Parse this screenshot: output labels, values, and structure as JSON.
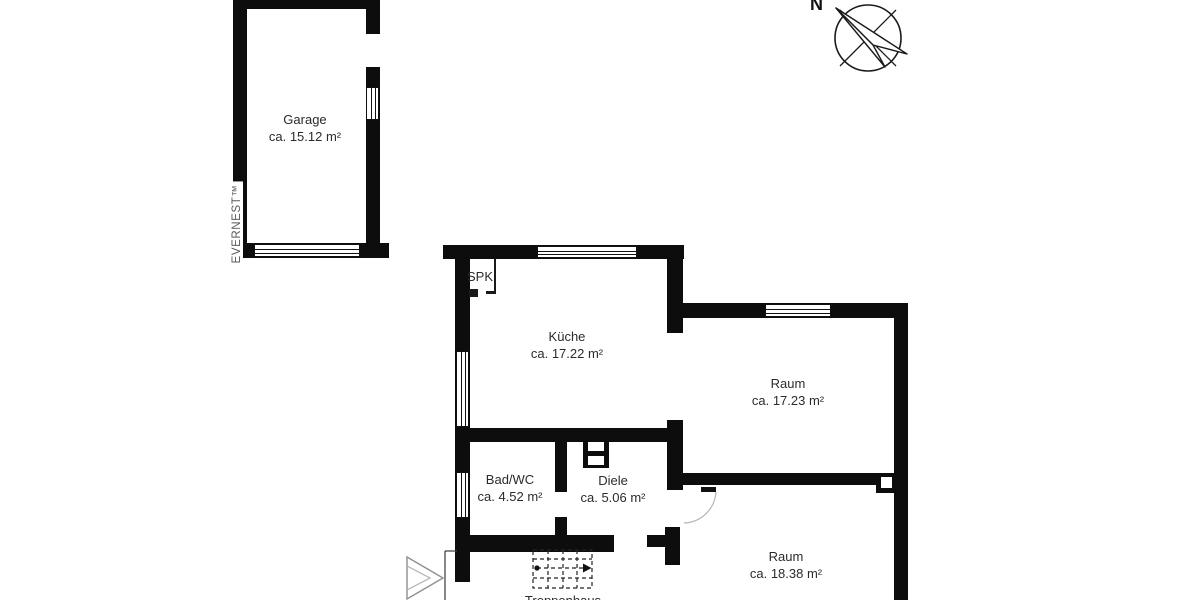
{
  "watermark": {
    "text": "EVERNEST™"
  },
  "compass": {
    "north_label": "N"
  },
  "rooms": {
    "garage": {
      "name": "Garage",
      "area": "ca. 15.12 m²"
    },
    "kueche": {
      "name": "Küche",
      "area": "ca. 17.22 m²"
    },
    "raum1": {
      "name": "Raum",
      "area": "ca. 17.23 m²"
    },
    "badwc": {
      "name": "Bad/WC",
      "area": "ca. 4.52 m²"
    },
    "diele": {
      "name": "Diele",
      "area": "ca. 5.06 m²"
    },
    "raum2": {
      "name": "Raum",
      "area": "ca. 18.38 m²"
    },
    "treppenhaus": {
      "name": "Treppenhaus"
    },
    "pantry": {
      "name": "SPK"
    }
  }
}
